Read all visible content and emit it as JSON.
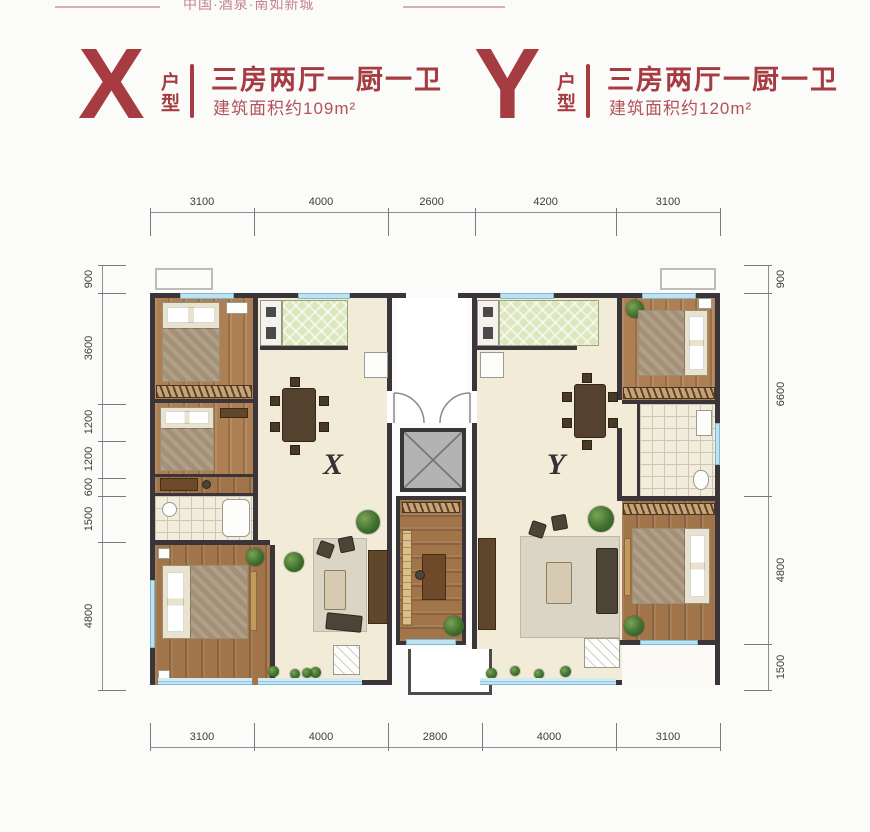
{
  "banner": {
    "project_text": "中国·酒泉·南如新城"
  },
  "units": [
    {
      "letter": "X",
      "type_suffix": "户型",
      "layout_title": "三房两厅一厨一卫",
      "area_text": "建筑面积约109m²",
      "plan_label": "X"
    },
    {
      "letter": "Y",
      "type_suffix": "户型",
      "layout_title": "三房两厅一厨一卫",
      "area_text": "建筑面积约120m²",
      "plan_label": "Y"
    }
  ],
  "dimensions_mm": {
    "top": [
      "3100",
      "4000",
      "2600",
      "4200",
      "3100"
    ],
    "bottom": [
      "3100",
      "4000",
      "2800",
      "4000",
      "3100"
    ],
    "left": [
      "900",
      "3600",
      "1200",
      "1200",
      "600",
      "1500",
      "4800"
    ],
    "right": [
      "900",
      "6600",
      "4800",
      "1500"
    ]
  },
  "colors": {
    "accent_red": "#a63c42",
    "wall_dark": "#3a3539",
    "window_blue": "#bfe2f0",
    "floor_beige": "#f1ebd7",
    "floor_wood": "#ad7f52",
    "kitchen_green": "#dde6bd"
  }
}
